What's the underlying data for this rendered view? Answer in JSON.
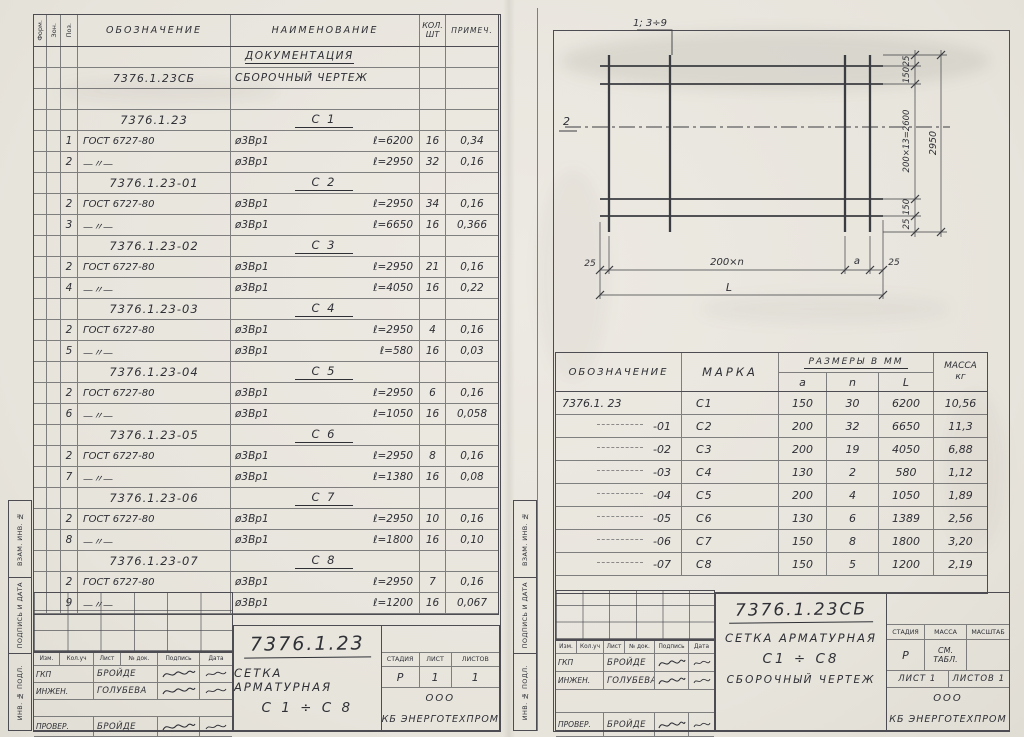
{
  "colors": {
    "paper": "#e9e6df",
    "ink": "#2f3036",
    "line": "#4c4c52"
  },
  "spec_table": {
    "headers": {
      "form": "Форм.",
      "zone": "Зон.",
      "pos": "Поз.",
      "designation": "ОБОЗНАЧЕНИЕ",
      "name": "НАИМЕНОВАНИЕ",
      "qty_line1": "КОЛ.",
      "qty_line2": "ШТ",
      "note": "ПРИМЕЧ."
    },
    "rows": [
      {
        "cls": "doc-head",
        "name": "ДОКУМЕНТАЦИЯ"
      },
      {
        "cls": "doc",
        "code": "7376.1.23СБ",
        "name": "СБОРОЧНЫЙ ЧЕРТЕЖ"
      },
      {
        "cls": "empty"
      },
      {
        "cls": "group",
        "code": "7376.1.23",
        "name": "С 1"
      },
      {
        "cls": "item",
        "pos": "1",
        "code": "ГОСТ 6727-80",
        "name": "ø3Вр1",
        "len": "ℓ=6200",
        "qty": "16",
        "note": "0,34"
      },
      {
        "cls": "item",
        "pos": "2",
        "code": "—〃—",
        "name": "ø3Вр1",
        "len": "ℓ=2950",
        "qty": "32",
        "note": "0,16"
      },
      {
        "cls": "group",
        "code": "7376.1.23-01",
        "name": "С 2"
      },
      {
        "cls": "item",
        "pos": "2",
        "code": "ГОСТ 6727-80",
        "name": "ø3Вр1",
        "len": "ℓ=2950",
        "qty": "34",
        "note": "0,16"
      },
      {
        "cls": "item",
        "pos": "3",
        "code": "—〃—",
        "name": "ø3Вр1",
        "len": "ℓ=6650",
        "qty": "16",
        "note": "0,366"
      },
      {
        "cls": "group",
        "code": "7376.1.23-02",
        "name": "С 3"
      },
      {
        "cls": "item",
        "pos": "2",
        "code": "ГОСТ 6727-80",
        "name": "ø3Вр1",
        "len": "ℓ=2950",
        "qty": "21",
        "note": "0,16"
      },
      {
        "cls": "item",
        "pos": "4",
        "code": "—〃—",
        "name": "ø3Вр1",
        "len": "ℓ=4050",
        "qty": "16",
        "note": "0,22"
      },
      {
        "cls": "group",
        "code": "7376.1.23-03",
        "name": "С 4"
      },
      {
        "cls": "item",
        "pos": "2",
        "code": "ГОСТ 6727-80",
        "name": "ø3Вр1",
        "len": "ℓ=2950",
        "qty": "4",
        "note": "0,16"
      },
      {
        "cls": "item",
        "pos": "5",
        "code": "—〃—",
        "name": "ø3Вр1",
        "len": "ℓ=580",
        "qty": "16",
        "note": "0,03"
      },
      {
        "cls": "group",
        "code": "7376.1.23-04",
        "name": "С 5"
      },
      {
        "cls": "item",
        "pos": "2",
        "code": "ГОСТ 6727-80",
        "name": "ø3Вр1",
        "len": "ℓ=2950",
        "qty": "6",
        "note": "0,16"
      },
      {
        "cls": "item",
        "pos": "6",
        "code": "—〃—",
        "name": "ø3Вр1",
        "len": "ℓ=1050",
        "qty": "16",
        "note": "0,058"
      },
      {
        "cls": "group",
        "code": "7376.1.23-05",
        "name": "С 6"
      },
      {
        "cls": "item",
        "pos": "2",
        "code": "ГОСТ 6727-80",
        "name": "ø3Вр1",
        "len": "ℓ=2950",
        "qty": "8",
        "note": "0,16"
      },
      {
        "cls": "item",
        "pos": "7",
        "code": "—〃—",
        "name": "ø3Вр1",
        "len": "ℓ=1380",
        "qty": "16",
        "note": "0,08"
      },
      {
        "cls": "group",
        "code": "7376.1.23-06",
        "name": "С 7"
      },
      {
        "cls": "item",
        "pos": "2",
        "code": "ГОСТ 6727-80",
        "name": "ø3Вр1",
        "len": "ℓ=2950",
        "qty": "10",
        "note": "0,16"
      },
      {
        "cls": "item",
        "pos": "8",
        "code": "—〃—",
        "name": "ø3Вр1",
        "len": "ℓ=1800",
        "qty": "16",
        "note": "0,10"
      },
      {
        "cls": "group",
        "code": "7376.1.23-07",
        "name": "С 8"
      },
      {
        "cls": "item",
        "pos": "2",
        "code": "ГОСТ 6727-80",
        "name": "ø3Вр1",
        "len": "ℓ=2950",
        "qty": "7",
        "note": "0,16"
      },
      {
        "cls": "item",
        "pos": "9",
        "code": "—〃—",
        "name": "ø3Вр1",
        "len": "ℓ=1200",
        "qty": "16",
        "note": "0,067"
      }
    ]
  },
  "drawing": {
    "callout_cross": "1; 3÷9",
    "callout_long": "2",
    "dims_right": {
      "top25": "25",
      "top150": "150",
      "pitch": "200×13=2600",
      "bot150": "150",
      "bot25": "25",
      "total": "2950"
    },
    "dims_bottom": {
      "left25": "25",
      "pitch": "200×n",
      "a": "a",
      "right25": "25",
      "total": "L"
    }
  },
  "mesh_table": {
    "headers": {
      "designation": "ОБОЗНАЧЕНИЕ",
      "mark": "МАРКА",
      "sizes": "РАЗМЕРЫ В ММ",
      "a": "a",
      "n": "n",
      "L": "L",
      "mass_line1": "МАССА",
      "mass_line2": "кг"
    },
    "rows": [
      {
        "cls": "first",
        "designation": "7376.1. 23",
        "mark": "С1",
        "a": "150",
        "n": "30",
        "L": "6200",
        "mass": "10,56"
      },
      {
        "cls": "cont",
        "designation": "-01",
        "mark": "С2",
        "a": "200",
        "n": "32",
        "L": "6650",
        "mass": "11,3"
      },
      {
        "cls": "cont",
        "designation": "-02",
        "mark": "С3",
        "a": "200",
        "n": "19",
        "L": "4050",
        "mass": "6,88"
      },
      {
        "cls": "cont",
        "designation": "-03",
        "mark": "С4",
        "a": "130",
        "n": "2",
        "L": "580",
        "mass": "1,12"
      },
      {
        "cls": "cont",
        "designation": "-04",
        "mark": "С5",
        "a": "200",
        "n": "4",
        "L": "1050",
        "mass": "1,89"
      },
      {
        "cls": "cont",
        "designation": "-05",
        "mark": "С6",
        "a": "130",
        "n": "6",
        "L": "1389",
        "mass": "2,56"
      },
      {
        "cls": "cont",
        "designation": "-06",
        "mark": "С7",
        "a": "150",
        "n": "8",
        "L": "1800",
        "mass": "3,20"
      },
      {
        "cls": "cont",
        "designation": "-07",
        "mark": "С8",
        "a": "150",
        "n": "5",
        "L": "1200",
        "mass": "2,19"
      }
    ]
  },
  "title_block_left": {
    "doc_number": "7376.1.23",
    "title_line1": "СЕТКА АРМАТУРНАЯ",
    "title_line2": "С 1 ÷ С 8",
    "sig_headers": [
      "Изм.",
      "Кол.уч",
      "Лист",
      "№ док.",
      "Подпись",
      "Дата"
    ],
    "sig_rows": [
      {
        "role": "ГКП",
        "name": "БРОЙДЕ"
      },
      {
        "role": "ИНЖЕН.",
        "name": "ГОЛУБЕВА"
      },
      {
        "role": "ПРОВЕР.",
        "name": "БРОЙДЕ"
      }
    ],
    "stage_headers": [
      "СТАДИЯ",
      "ЛИСТ",
      "ЛИСТОВ"
    ],
    "stage_values": [
      "Р",
      "1",
      "1"
    ],
    "org_line1": "ООО",
    "org_line2": "КБ ЭНЕРГОТЕХПРОМ"
  },
  "title_block_right": {
    "doc_number": "7376.1.23СБ",
    "title_line1": "СЕТКА АРМАТУРНАЯ",
    "title_line2": "С1 ÷ С8",
    "title_line3": "СБОРОЧНЫЙ ЧЕРТЕЖ",
    "sig_headers": [
      "Изм.",
      "Кол.уч",
      "Лист",
      "№ док.",
      "Подпись",
      "Дата"
    ],
    "sig_rows": [
      {
        "role": "ГКП",
        "name": "БРОЙДЕ"
      },
      {
        "role": "ИНЖЕН.",
        "name": "ГОЛУБЕВА"
      },
      {
        "role": "ПРОВЕР.",
        "name": "БРОЙДЕ"
      }
    ],
    "stage_headers": [
      "СТАДИЯ",
      "МАССА",
      "МАСШТАБ"
    ],
    "stage_values": [
      "Р",
      "СМ. ТАБЛ.",
      ""
    ],
    "sheet_cells": [
      "ЛИСТ 1",
      "ЛИСТОВ 1"
    ],
    "org_line1": "ООО",
    "org_line2": "КБ ЭНЕРГОТЕХПРОМ"
  },
  "side_stamp": {
    "labels": [
      "ВЗАМ. ИНВ. №",
      "ПОДПИСЬ И ДАТА",
      "ИНВ. № ПОДЛ."
    ]
  }
}
